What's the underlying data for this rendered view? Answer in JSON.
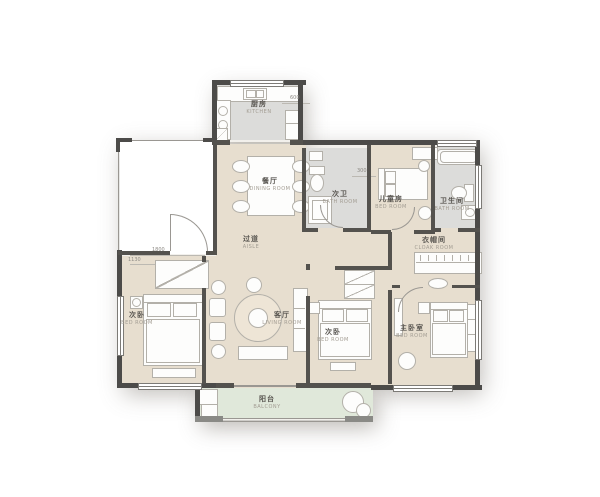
{
  "plan": {
    "type": "apartment-floor-plan",
    "colors": {
      "floor_main": "#e7decf",
      "floor_wet": "#dcdcda",
      "floor_balcony": "#e0e8da",
      "wall": "#4c4b49",
      "furniture_line": "#b3b0a9"
    },
    "rooms": [
      {
        "zh": "厨房",
        "en": "KITCHEN"
      },
      {
        "zh": "餐厅",
        "en": "DINING ROOM"
      },
      {
        "zh": "次卫",
        "en": "BATH ROOM"
      },
      {
        "zh": "儿童房",
        "en": "BED ROOM"
      },
      {
        "zh": "卫生间",
        "en": "BATH ROOM"
      },
      {
        "zh": "过道",
        "en": "AISLE"
      },
      {
        "zh": "衣帽间",
        "en": "CLOAK ROOM"
      },
      {
        "zh": "次卧",
        "en": "BED ROOM"
      },
      {
        "zh": "客厅",
        "en": "LIVING ROOM"
      },
      {
        "zh": "次卧",
        "en": "BED ROOM"
      },
      {
        "zh": "主卧室",
        "en": "BED ROOM"
      },
      {
        "zh": "阳台",
        "en": "BALCONY"
      }
    ],
    "dimensions": [
      {
        "value": "600"
      },
      {
        "value": "1800"
      },
      {
        "value": "1130"
      },
      {
        "value": "300"
      }
    ]
  }
}
